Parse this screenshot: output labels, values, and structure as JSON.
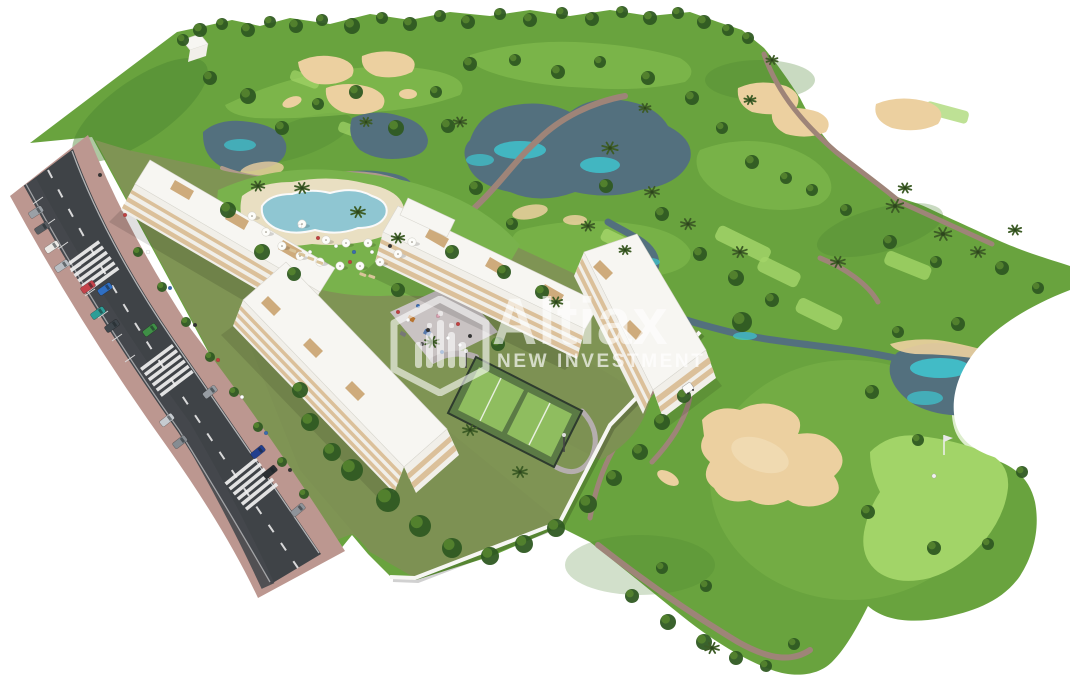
{
  "watermark": {
    "brand": "Altiax",
    "tagline": "NEW INVESTMENT",
    "logo_icon": "hexagon-city-icon",
    "color": "#ffffff"
  },
  "scene": {
    "description": "Aerial 3D render of a white apartment development with lagoon pool, padel courts and gardens beside a golf course with lakes, sand bunkers, putting green, palm trees and a two-lane road with parked cars in the foreground.",
    "palette": {
      "grass": "#69a33e",
      "grass_dark": "#4c8531",
      "fairway": "#8cc554",
      "green_bright": "#a2d468",
      "sand": "#ecd0a0",
      "water": "#53707e",
      "water_highlight": "#3fc8d2",
      "path": "#9e8478",
      "road": "#3f4347",
      "road_marking": "#f0f0f0",
      "sidewalk": "#bc9790",
      "building": "#f7f6f2",
      "balcony": "#d9bc92",
      "pool": "#8fc6d2",
      "pool_deck": "#e9dfc2",
      "lawn": "#79b24c",
      "garden": "#7d9153",
      "court": "#5b7a45",
      "court_inner": "#8fbd5f",
      "tree": "#2f5a22",
      "tree_light": "#55842f",
      "palm": "#3d5c26",
      "wall": "#f6f6f3"
    },
    "trees": [
      [
        183,
        40,
        6
      ],
      [
        200,
        30,
        7
      ],
      [
        222,
        24,
        6
      ],
      [
        248,
        30,
        7
      ],
      [
        270,
        22,
        6
      ],
      [
        296,
        26,
        7
      ],
      [
        322,
        20,
        6
      ],
      [
        352,
        26,
        8
      ],
      [
        382,
        18,
        6
      ],
      [
        410,
        24,
        7
      ],
      [
        440,
        16,
        6
      ],
      [
        468,
        22,
        7
      ],
      [
        500,
        14,
        6
      ],
      [
        530,
        20,
        7
      ],
      [
        562,
        13,
        6
      ],
      [
        592,
        19,
        7
      ],
      [
        622,
        12,
        6
      ],
      [
        650,
        18,
        7
      ],
      [
        678,
        13,
        6
      ],
      [
        704,
        22,
        7
      ],
      [
        728,
        30,
        6
      ],
      [
        748,
        38,
        6
      ],
      [
        210,
        78,
        7
      ],
      [
        248,
        96,
        8
      ],
      [
        282,
        128,
        7
      ],
      [
        318,
        104,
        6
      ],
      [
        356,
        92,
        7
      ],
      [
        396,
        128,
        8
      ],
      [
        436,
        92,
        6
      ],
      [
        470,
        64,
        7
      ],
      [
        515,
        60,
        6
      ],
      [
        558,
        72,
        7
      ],
      [
        600,
        62,
        6
      ],
      [
        648,
        78,
        7
      ],
      [
        692,
        98,
        7
      ],
      [
        722,
        128,
        6
      ],
      [
        752,
        162,
        7
      ],
      [
        786,
        178,
        6
      ],
      [
        812,
        190,
        6
      ],
      [
        448,
        126,
        7
      ],
      [
        476,
        188,
        7
      ],
      [
        512,
        224,
        6
      ],
      [
        606,
        186,
        7
      ],
      [
        662,
        214,
        7
      ],
      [
        700,
        254,
        7
      ],
      [
        736,
        278,
        8
      ],
      [
        742,
        322,
        10
      ],
      [
        772,
        300,
        7
      ],
      [
        846,
        210,
        6
      ],
      [
        890,
        242,
        7
      ],
      [
        936,
        262,
        6
      ],
      [
        1002,
        268,
        7
      ],
      [
        1038,
        288,
        6
      ],
      [
        958,
        324,
        7
      ],
      [
        898,
        332,
        6
      ],
      [
        872,
        392,
        7
      ],
      [
        918,
        440,
        6
      ],
      [
        868,
        512,
        7
      ],
      [
        934,
        548,
        7
      ],
      [
        988,
        544,
        6
      ],
      [
        1022,
        472,
        6
      ],
      [
        632,
        596,
        7
      ],
      [
        668,
        622,
        8
      ],
      [
        704,
        642,
        8
      ],
      [
        736,
        658,
        7
      ],
      [
        766,
        666,
        6
      ],
      [
        794,
        644,
        6
      ],
      [
        706,
        586,
        6
      ],
      [
        662,
        568,
        6
      ],
      [
        352,
        470,
        11
      ],
      [
        388,
        500,
        12
      ],
      [
        420,
        526,
        11
      ],
      [
        452,
        548,
        10
      ],
      [
        490,
        556,
        9
      ],
      [
        524,
        544,
        9
      ],
      [
        556,
        528,
        9
      ],
      [
        588,
        504,
        9
      ],
      [
        614,
        478,
        8
      ],
      [
        640,
        452,
        8
      ],
      [
        662,
        422,
        8
      ],
      [
        684,
        396,
        7
      ],
      [
        310,
        422,
        9
      ],
      [
        332,
        452,
        9
      ],
      [
        300,
        390,
        8
      ],
      [
        398,
        290,
        7
      ],
      [
        498,
        344,
        7
      ],
      [
        228,
        210,
        8
      ],
      [
        262,
        252,
        8
      ],
      [
        294,
        274,
        7
      ],
      [
        452,
        252,
        7
      ],
      [
        504,
        272,
        7
      ],
      [
        542,
        292,
        7
      ],
      [
        138,
        252,
        5
      ],
      [
        162,
        287,
        5
      ],
      [
        186,
        322,
        5
      ],
      [
        210,
        357,
        5
      ],
      [
        234,
        392,
        5
      ],
      [
        258,
        427,
        5
      ],
      [
        282,
        462,
        5
      ],
      [
        304,
        494,
        5
      ]
    ],
    "palms": [
      [
        302,
        188,
        1
      ],
      [
        358,
        212,
        1
      ],
      [
        610,
        148,
        1.1
      ],
      [
        652,
        192,
        1
      ],
      [
        688,
        224,
        1
      ],
      [
        740,
        252,
        1
      ],
      [
        838,
        262,
        1
      ],
      [
        895,
        206,
        1.2
      ],
      [
        943,
        234,
        1.2
      ],
      [
        978,
        252,
        1
      ],
      [
        1015,
        230,
        0.9
      ],
      [
        460,
        122,
        0.9
      ],
      [
        366,
        122,
        0.8
      ],
      [
        432,
        342,
        1
      ],
      [
        470,
        430,
        1
      ],
      [
        520,
        472,
        1
      ],
      [
        556,
        302,
        0.9
      ],
      [
        258,
        186,
        0.9
      ],
      [
        398,
        238,
        0.9
      ],
      [
        712,
        648,
        1
      ],
      [
        750,
        100,
        0.8
      ],
      [
        772,
        60,
        0.8
      ],
      [
        905,
        188,
        0.9
      ],
      [
        645,
        108,
        0.8
      ],
      [
        588,
        226,
        0.9
      ],
      [
        625,
        250,
        0.8
      ]
    ],
    "cars": [
      [
        36,
        212,
        57,
        "#9aa0a6"
      ],
      [
        42,
        228,
        57,
        "#565b60"
      ],
      [
        52,
        247,
        56,
        "#eceae6"
      ],
      [
        62,
        266,
        56,
        "#b9bec3"
      ],
      [
        88,
        287,
        55,
        "#c4434b"
      ],
      [
        105,
        289,
        55,
        "#2f6fc4"
      ],
      [
        98,
        313,
        55,
        "#2e9e97"
      ],
      [
        112,
        326,
        55,
        "#3f474d"
      ],
      [
        150,
        330,
        53,
        "#3f8f46"
      ],
      [
        167,
        420,
        52,
        "#c6cbd0"
      ],
      [
        180,
        442,
        52,
        "#868c92"
      ],
      [
        210,
        392,
        52,
        "#969ca2"
      ],
      [
        258,
        452,
        51,
        "#223f8e"
      ],
      [
        270,
        472,
        51,
        "#2b2f33"
      ],
      [
        298,
        510,
        50,
        "#8e9399"
      ]
    ],
    "umbrellas": [
      [
        252,
        216
      ],
      [
        266,
        232
      ],
      [
        282,
        246
      ],
      [
        300,
        256
      ],
      [
        320,
        262
      ],
      [
        340,
        266
      ],
      [
        360,
        266
      ],
      [
        380,
        262
      ],
      [
        398,
        254
      ],
      [
        412,
        242
      ],
      [
        302,
        224
      ],
      [
        346,
        243
      ],
      [
        368,
        243
      ],
      [
        326,
        240
      ]
    ],
    "loungers": [
      [
        290,
        248
      ],
      [
        299,
        252
      ],
      [
        308,
        256
      ],
      [
        317,
        260
      ],
      [
        360,
        272
      ],
      [
        369,
        274
      ]
    ],
    "people": [
      [
        398,
        312,
        "#c04040"
      ],
      [
        408,
        320,
        "#ffffff"
      ],
      [
        418,
        306,
        "#3a6bb0"
      ],
      [
        428,
        330,
        "#333333"
      ],
      [
        438,
        316,
        "#d8a0b0"
      ],
      [
        448,
        338,
        "#ffffff"
      ],
      [
        458,
        324,
        "#c04040"
      ],
      [
        422,
        344,
        "#555555"
      ],
      [
        442,
        352,
        "#3a6bb0"
      ],
      [
        460,
        345,
        "#ffffff"
      ],
      [
        470,
        336,
        "#333333"
      ],
      [
        300,
        226,
        "#ffffff"
      ],
      [
        318,
        238,
        "#c04040"
      ],
      [
        336,
        246,
        "#ffffff"
      ],
      [
        354,
        252,
        "#3a6bb0"
      ],
      [
        372,
        252,
        "#ffffff"
      ],
      [
        390,
        246,
        "#333333"
      ],
      [
        310,
        252,
        "#ffffff"
      ],
      [
        350,
        262,
        "#c04040"
      ],
      [
        100,
        175,
        "#333333"
      ],
      [
        125,
        215,
        "#c04040"
      ],
      [
        148,
        252,
        "#ffffff"
      ],
      [
        170,
        288,
        "#3a6bb0"
      ],
      [
        195,
        325,
        "#333333"
      ],
      [
        218,
        360,
        "#c04040"
      ],
      [
        242,
        397,
        "#ffffff"
      ],
      [
        266,
        433,
        "#3a6bb0"
      ],
      [
        290,
        470,
        "#333333"
      ]
    ],
    "golf": {
      "flag": [
        944,
        455
      ],
      "golfer": [
        934,
        476
      ],
      "cart": [
        688,
        388
      ]
    }
  }
}
